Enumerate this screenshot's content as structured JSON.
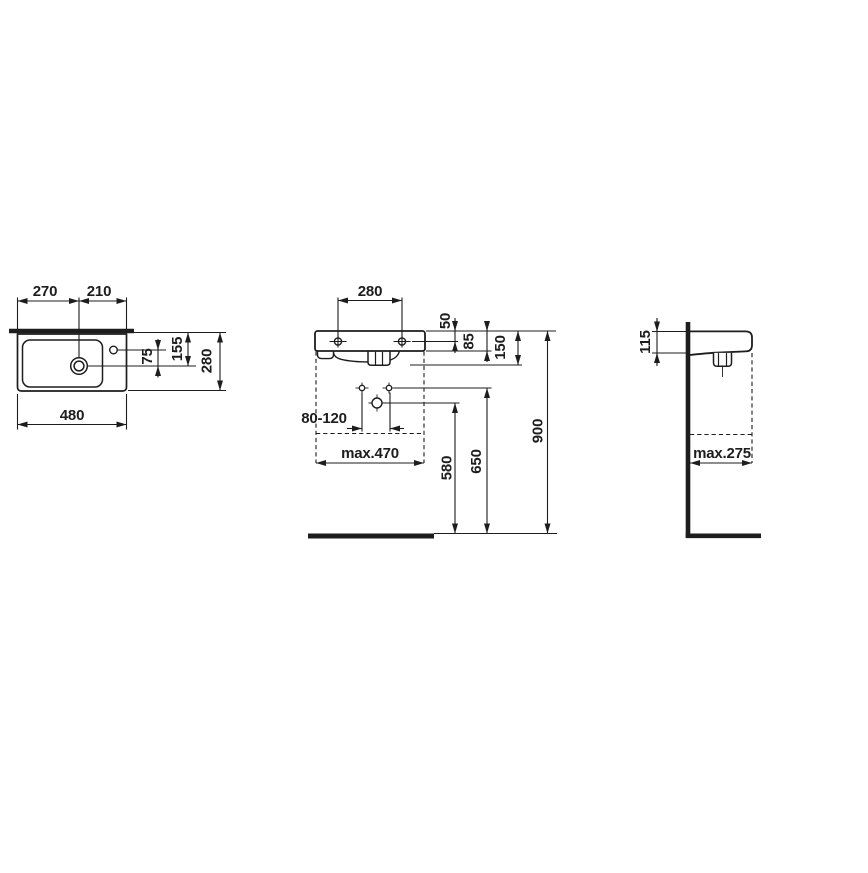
{
  "drawing": {
    "background_color": "#ffffff",
    "ink_color": "#1d1d1d",
    "views": {
      "plan": {
        "dims": {
          "left_edge_to_drain": "270",
          "drain_to_right_edge": "210",
          "overall_width": "480",
          "tap_hole_to_drain": "75",
          "rear_to_drain": "155",
          "overall_depth": "280"
        }
      },
      "front": {
        "dims": {
          "fixing_hole_spacing": "280",
          "rim_to_fixing_holes": "50",
          "rim_to_body_bottom": "85",
          "rim_to_outlet_bottom": "150",
          "supply_connection_spacing": "80-120",
          "max_fitting_width": "max.470",
          "waste_outlet_height": "580",
          "supply_connection_height": "650",
          "rim_height": "900"
        }
      },
      "side": {
        "dims": {
          "front_edge_height": "115",
          "max_fitting_depth": "max.275"
        }
      }
    }
  }
}
